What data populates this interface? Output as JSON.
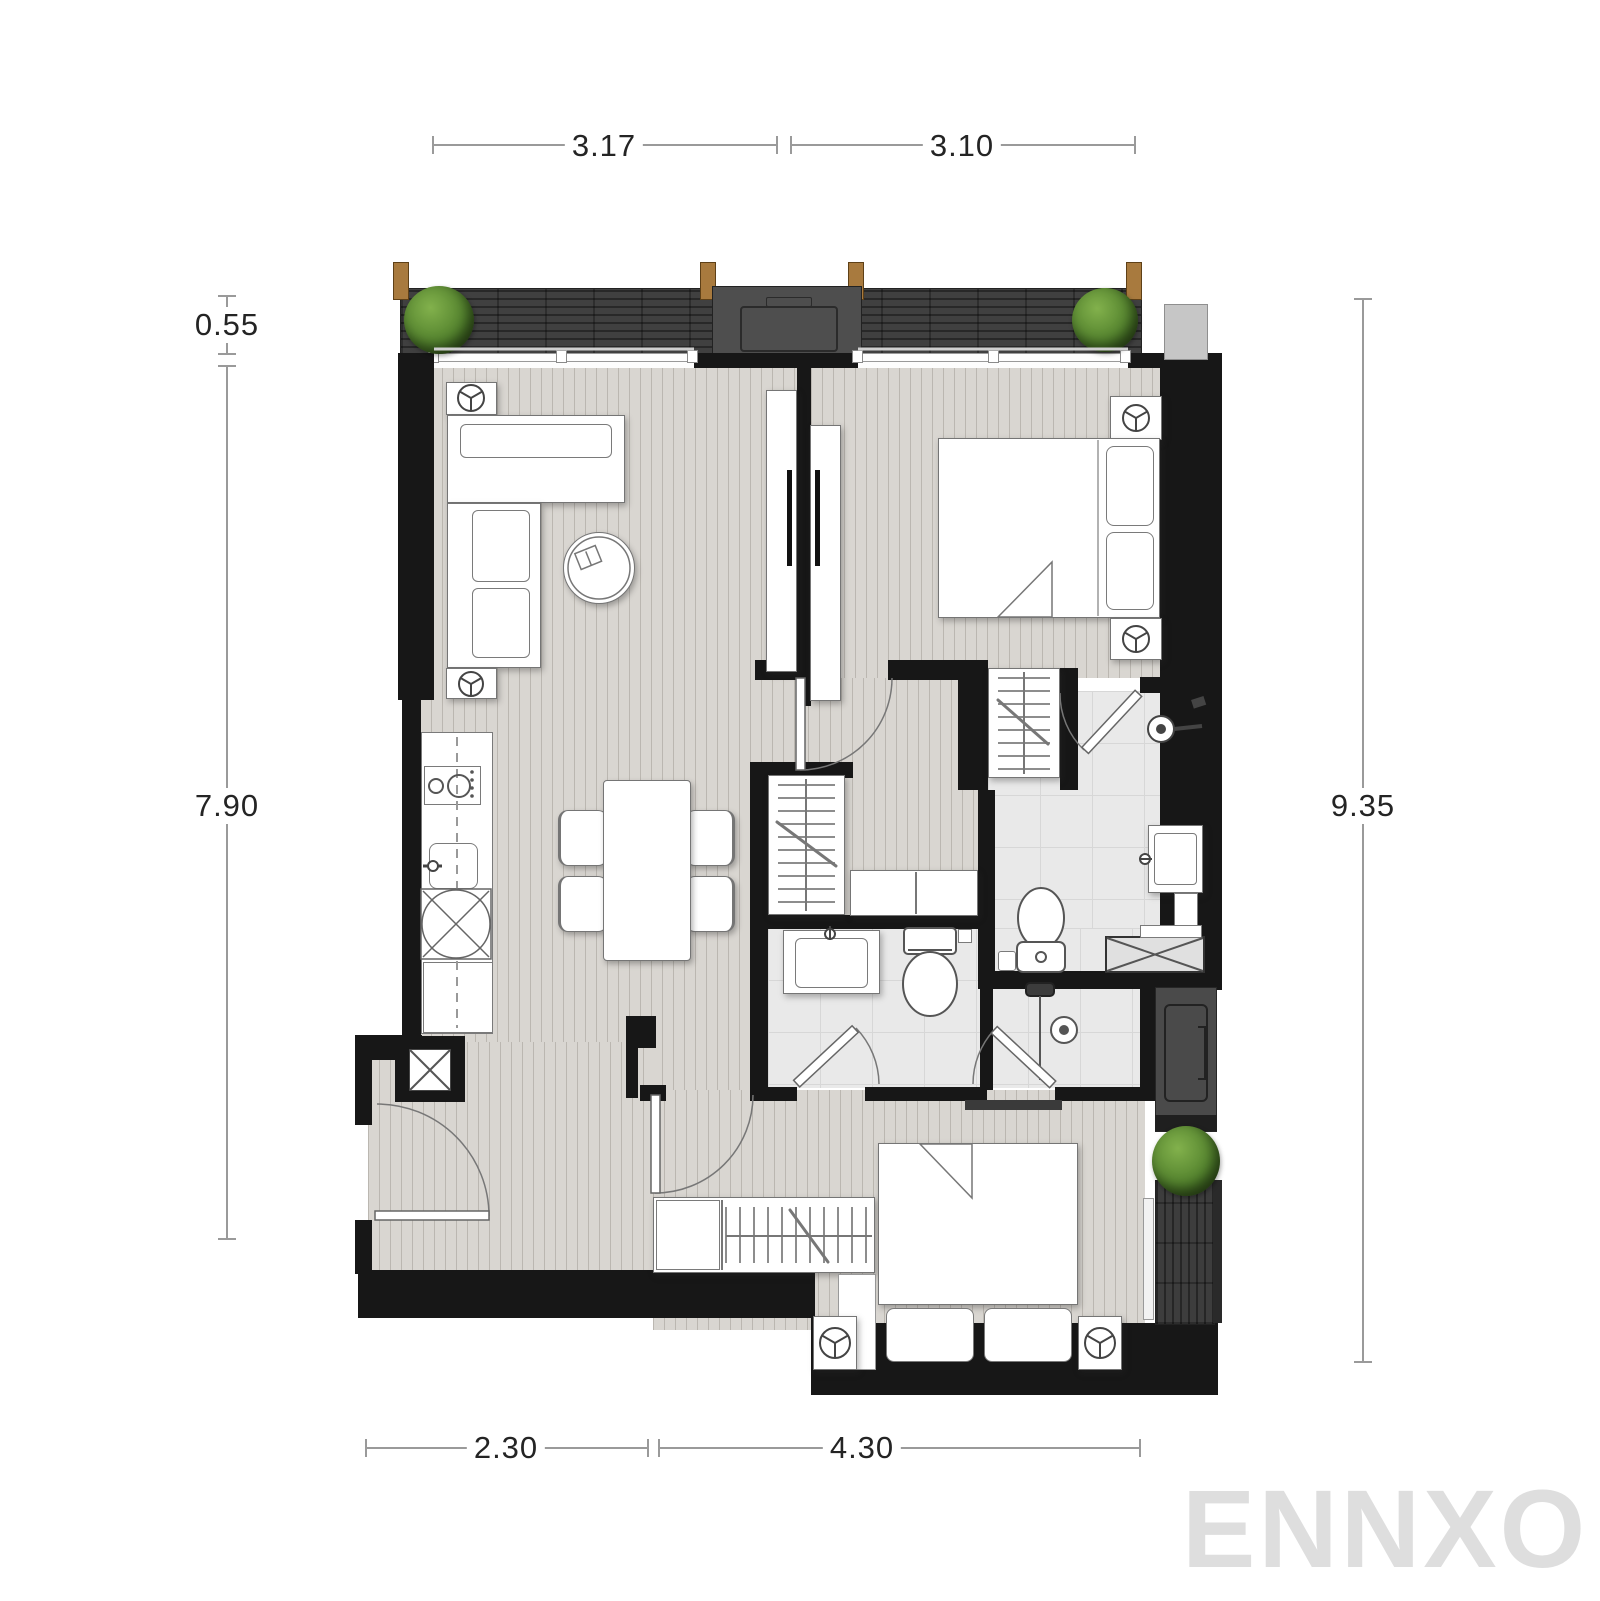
{
  "page": {
    "type": "architectural-floor-plan",
    "units": "meters"
  },
  "watermark": {
    "text": "ENNXO"
  },
  "dimensions": {
    "top": [
      {
        "label": "3.17"
      },
      {
        "label": "3.10"
      }
    ],
    "left": [
      {
        "label": "0.55"
      },
      {
        "label": "7.90"
      }
    ],
    "right": [
      {
        "label": "9.35"
      }
    ],
    "bottom": [
      {
        "label": "2.30"
      },
      {
        "label": "4.30"
      }
    ]
  },
  "colors": {
    "wall": "#171717",
    "floor": "#d9d6d1",
    "bathroom_tile": "#e9e9e9",
    "balcony_deck": "#404040",
    "plant_green": "#4e7d2a",
    "wood_post": "#a87a3e",
    "dimension_line": "#9a9a9a",
    "dimension_text": "#242424",
    "watermark_gray": "#dedede"
  }
}
